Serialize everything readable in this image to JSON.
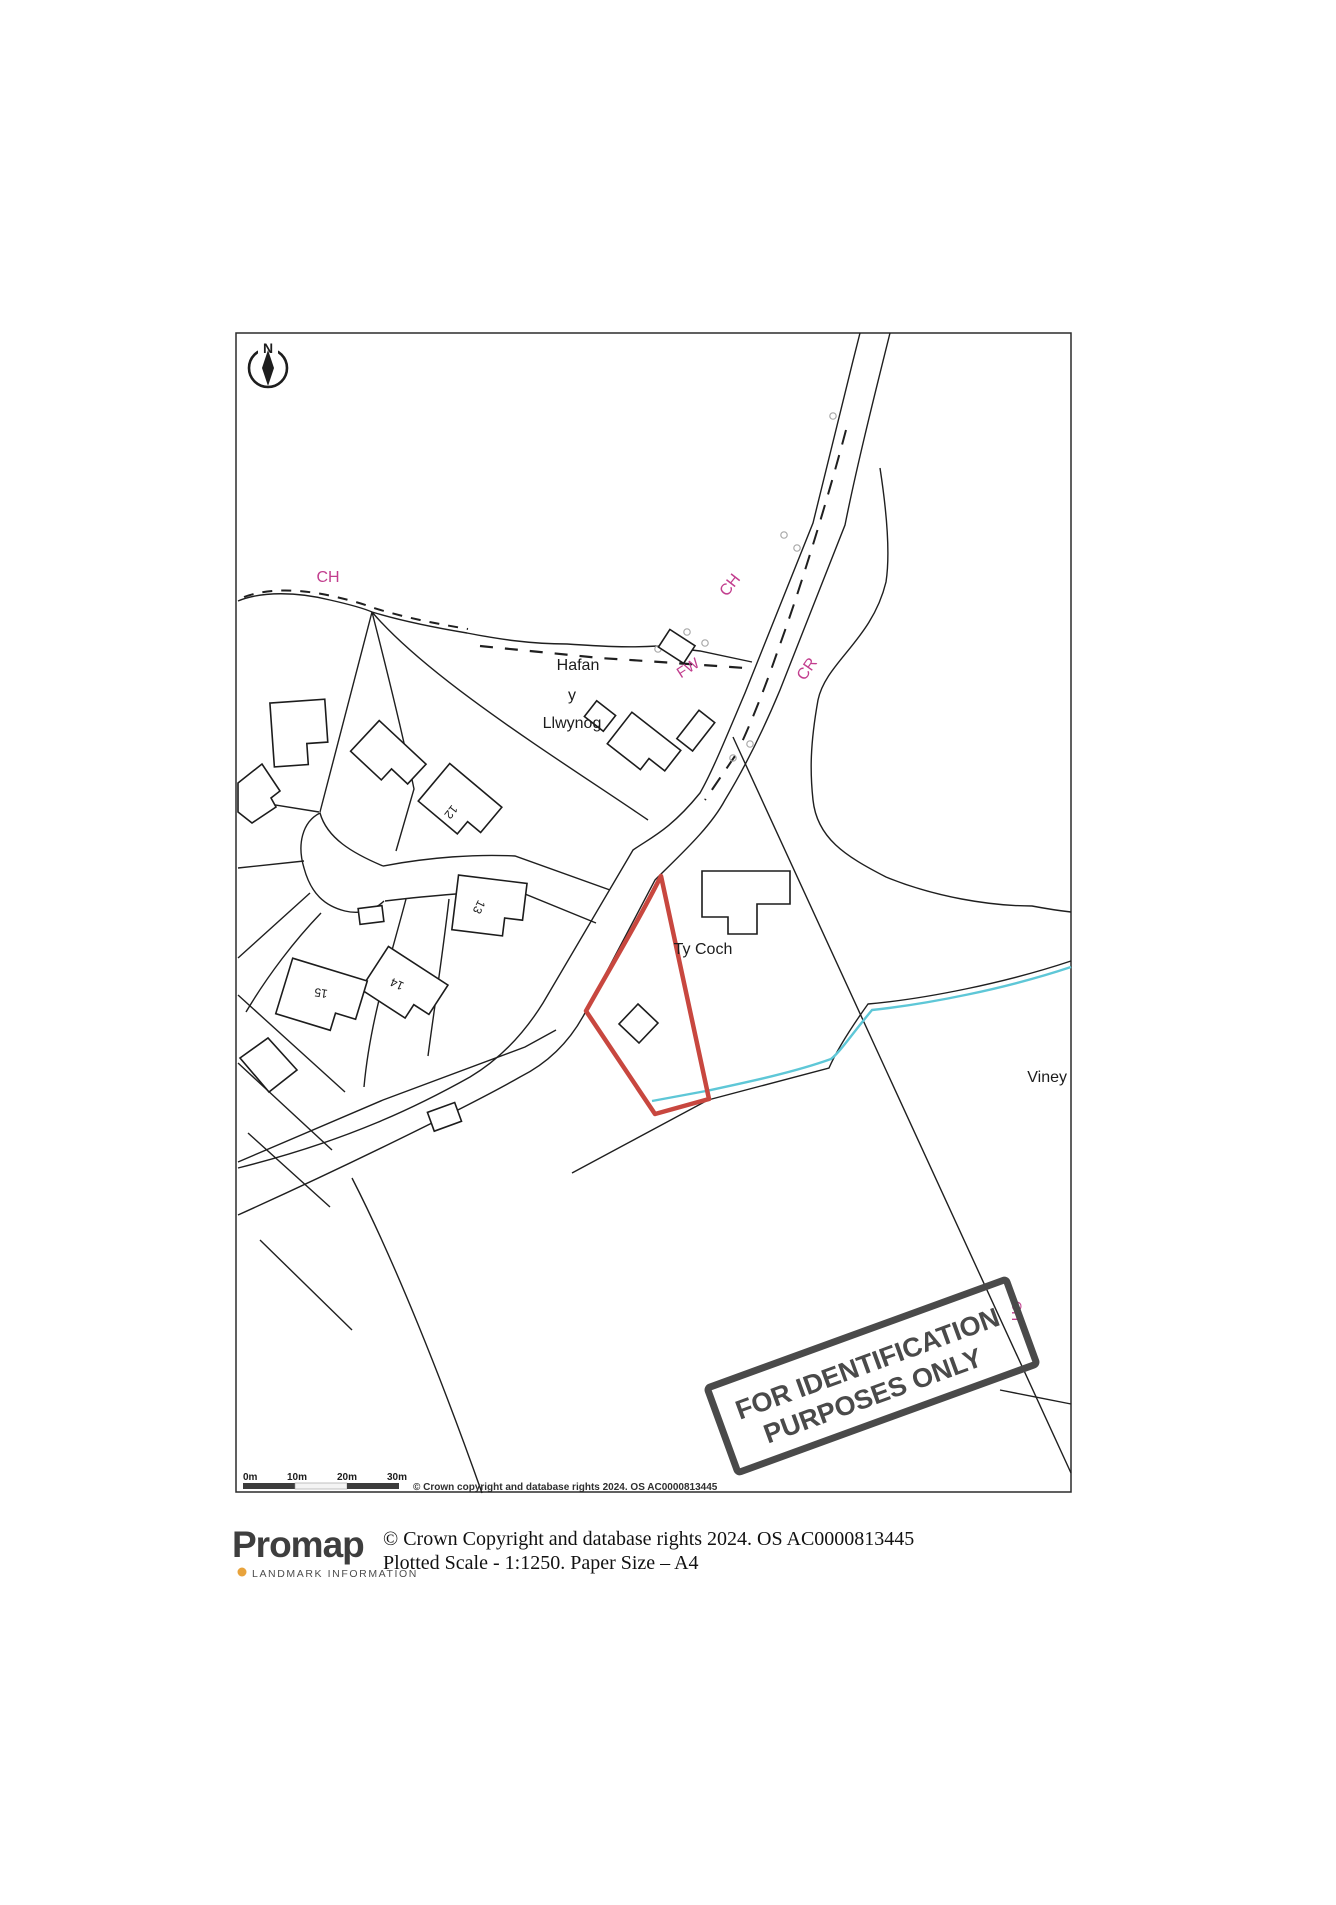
{
  "map": {
    "compass_label": "N",
    "labels": {
      "ch_top": "CH",
      "ch_road": "CH",
      "cr": "CR",
      "fw": "FW",
      "ch_stamp": "CH",
      "hafan_1": "Hafan",
      "hafan_2": "y",
      "hafan_3": "Llwynog",
      "ty_coch": "Ty Coch",
      "viney": "Viney",
      "plot_12": "12",
      "plot_13": "13",
      "plot_14": "14",
      "plot_15": "15"
    },
    "stamp": {
      "line1": "FOR IDENTIFICATION",
      "line2": "PURPOSES ONLY"
    },
    "scalebar": {
      "t0": "0m",
      "t10": "10m",
      "t20": "20m",
      "t30": "30m"
    },
    "copyright": "© Crown copyright and database rights 2024. OS AC0000813445",
    "colors": {
      "plot_outline": "#c8473f",
      "stream": "#5ec7d7",
      "label_magenta": "#c23e8e",
      "stamp_ink": "#4a4a4a"
    }
  },
  "footer": {
    "logo": "Promap",
    "logo_sub": "LANDMARK INFORMATION",
    "logo_dot_color": "#e8a33c",
    "line1": "© Crown Copyright and database rights 2024. OS AC0000813445",
    "line2": "Plotted Scale - 1:1250. Paper Size – A4"
  }
}
